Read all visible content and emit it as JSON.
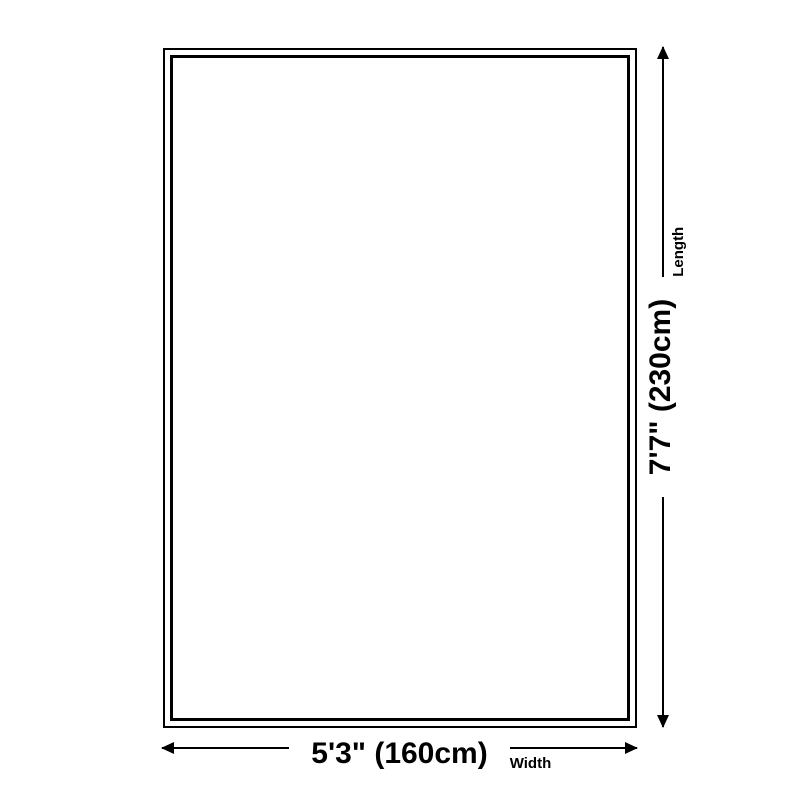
{
  "diagram": {
    "width_dimension": {
      "value": "5'3\" (160cm)",
      "axis_label": "Width"
    },
    "length_dimension": {
      "value": "7'7\" (230cm)",
      "axis_label": "Length"
    },
    "colors": {
      "line": "#000000",
      "background": "#ffffff"
    }
  }
}
